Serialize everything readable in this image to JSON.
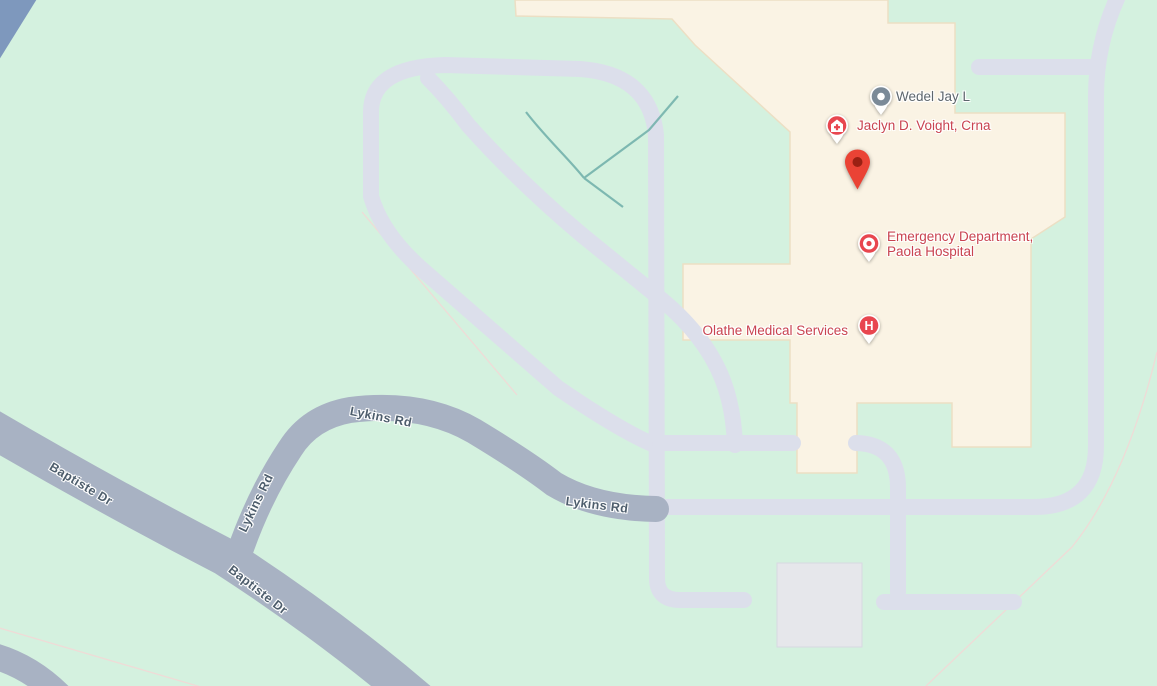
{
  "map": {
    "type": "street-map",
    "area": "Paola Hospital campus, Lykins Rd / Baptiste Dr",
    "colors": {
      "background_green": "#d4f1df",
      "hospital_parcel_cream": "#faf3e4",
      "parcel_border_tan": "#ecdfc4",
      "main_road_gray": "#a8b2c3",
      "highway_blue": "#7e98bd",
      "minor_road_lavender": "#dcdfeb",
      "building_gray": "#e6e7eb",
      "creek_teal": "#6fafa9",
      "parcel_line_pink": "#efdbd7",
      "poi_text_red": "#c94350",
      "poi_text_gray": "#5d666d",
      "road_label_gray": "#4d5d6c",
      "marker_red": "#e8464f",
      "marker_slate": "#7b8a98",
      "pin_red": "#ea4335",
      "pin_dot_dark_red": "#9a2013"
    },
    "markers": {
      "wedel": {
        "label": "Wedel Jay L",
        "icon": "place-dot-icon"
      },
      "jaclyn": {
        "label": "Jaclyn D. Voight, Crna",
        "icon": "medical-office-icon"
      },
      "pin": {
        "icon": "red-location-pin-icon"
      },
      "emergency": {
        "label_line1": "Emergency Department,",
        "label_line2": "Paola Hospital",
        "icon": "emergency-ring-icon"
      },
      "olathe": {
        "label": "Olathe Medical Services",
        "icon": "hospital-h-icon",
        "icon_letter": "H"
      }
    },
    "road_labels": {
      "lykins_upper": "Lykins Rd",
      "lykins_lower": "Lykins Rd",
      "lykins_vertical": "Lykins Rd",
      "baptiste_upper": "Baptiste Dr",
      "baptiste_lower": "Baptiste Dr"
    }
  }
}
